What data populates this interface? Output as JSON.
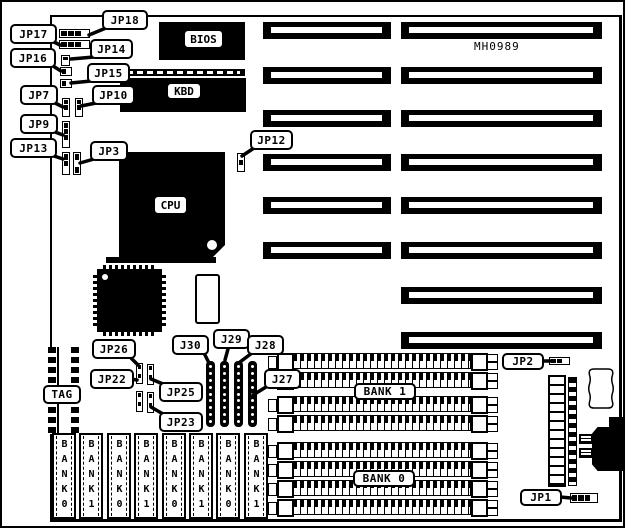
{
  "board": {
    "model": "MH0989"
  },
  "chips": {
    "bios": "BIOS",
    "kbd": "KBD",
    "cpu": "CPU"
  },
  "memory": {
    "simm_rows_per_group": 4,
    "dip_labels": [
      "BANK0",
      "BANK1",
      "BANK0",
      "BANK1",
      "BANK0",
      "BANK1",
      "BANK0",
      "BANK1"
    ]
  },
  "slots": {
    "left_count": 6,
    "right_count": 8
  },
  "callouts": {
    "jp18": "JP18",
    "jp17": "JP17",
    "jp14": "JP14",
    "jp16": "JP16",
    "jp15": "JP15",
    "jp7": "JP7",
    "jp10": "JP10",
    "jp9": "JP9",
    "jp13": "JP13",
    "jp3": "JP3",
    "jp12": "JP12",
    "jp26": "JP26",
    "jp22": "JP22",
    "jp25": "JP25",
    "jp23": "JP23",
    "j30": "J30",
    "j29": "J29",
    "j28": "J28",
    "j27": "J27",
    "tag": "TAG",
    "bank1": "BANK 1",
    "bank0": "BANK 0",
    "jp2": "JP2",
    "jp1": "JP1"
  }
}
